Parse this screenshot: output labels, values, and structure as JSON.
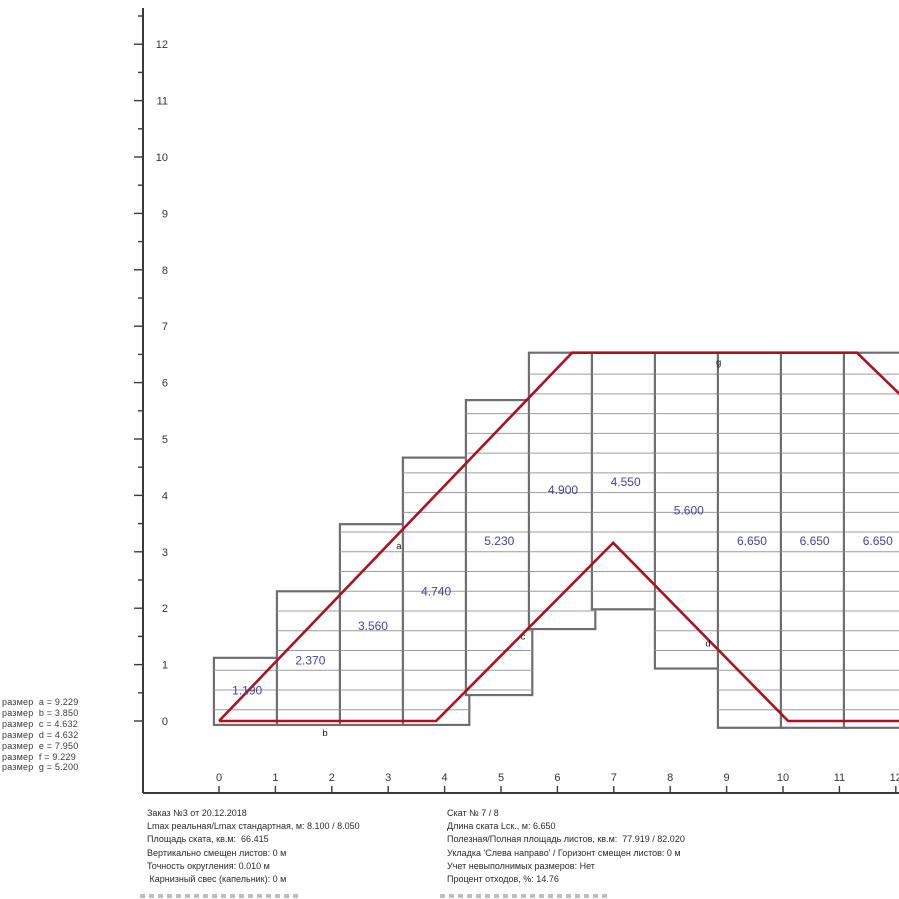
{
  "page": {
    "background": "#ffffff"
  },
  "legend": {
    "label_prefix": "размер",
    "items": [
      {
        "name": "a",
        "value": "9.229"
      },
      {
        "name": "b",
        "value": "3.850"
      },
      {
        "name": "c",
        "value": "4.632"
      },
      {
        "name": "d",
        "value": "4.632"
      },
      {
        "name": "e",
        "value": "7.950"
      },
      {
        "name": "f",
        "value": "9.229"
      },
      {
        "name": "g",
        "value": "5.200"
      }
    ]
  },
  "info_panel": {
    "left_lines": [
      "Заказ №3 от 20.12.2018",
      "Lmax реальная/Lmax стандартная, м: 8.100 / 8.050",
      "Площадь ската, кв.м:  66.415",
      "Вертикально смещен листов: 0 м",
      "Точность округления: 0.010 м",
      " Карнизный свес (капельник): 0 м"
    ],
    "right_lines": [
      "Скат № 7 / 8",
      "Длина ската Lск., м: 6.650",
      "Полезная/Полная площадь листов, кв.м:  77.919 / 82.020",
      "Укладка 'Слева направо' / Горизонт смещен листов: 0 м",
      "Учет невыполнимых размеров: Нет",
      "Процент отходов, %: 14.76"
    ]
  },
  "chart_data": {
    "type": "roof-sheet-layout",
    "title": "",
    "origin_px": [
      219,
      721
    ],
    "unit_px": 56.4,
    "axis_px": {
      "y_axis_x": 143,
      "x_axis_y": 793,
      "y_axis_top": 8
    },
    "x_axis": {
      "min": 0,
      "max": 12,
      "tick_step": 1,
      "labels": [
        "0",
        "1",
        "2",
        "3",
        "4",
        "5",
        "6",
        "7",
        "8",
        "9",
        "10",
        "11",
        "12"
      ]
    },
    "y_axis": {
      "min": 0,
      "max": 12,
      "tick_step": 1,
      "minor_step": 0.5,
      "minor_max": 12.5,
      "labels": [
        "0",
        "1",
        "2",
        "3",
        "4",
        "5",
        "6",
        "7",
        "8",
        "9",
        "10",
        "11",
        "12"
      ]
    },
    "module_row_step": 0.35,
    "module_row_origin": -0.15,
    "sheet_columns": [
      {
        "label": "1.190",
        "x": -0.09,
        "w": 1.177,
        "y0": -0.07,
        "y1": 1.12,
        "lx": 0.5,
        "ly": 0.54
      },
      {
        "label": "2.370",
        "x": 1.027,
        "w": 1.177,
        "y0": -0.07,
        "y1": 2.3,
        "lx": 1.62,
        "ly": 1.07
      },
      {
        "label": "3.560",
        "x": 2.144,
        "w": 1.177,
        "y0": -0.07,
        "y1": 3.49,
        "lx": 2.73,
        "ly": 1.68
      },
      {
        "label": "4.740",
        "x": 3.261,
        "w": 1.177,
        "y0": -0.07,
        "y1": 4.67,
        "lx": 3.85,
        "ly": 2.3
      },
      {
        "label": "5.230",
        "x": 4.378,
        "w": 1.177,
        "y0": 0.46,
        "y1": 5.69,
        "lx": 4.97,
        "ly": 3.19
      },
      {
        "label": "4.900",
        "x": 5.495,
        "w": 1.177,
        "y0": 1.63,
        "y1": 6.53,
        "lx": 6.1,
        "ly": 4.1
      },
      {
        "label": "4.550",
        "x": 6.612,
        "w": 1.177,
        "y0": 1.98,
        "y1": 6.53,
        "lx": 7.21,
        "ly": 4.24
      },
      {
        "label": "5.600",
        "x": 7.729,
        "w": 1.177,
        "y0": 0.93,
        "y1": 6.53,
        "lx": 8.33,
        "ly": 3.73
      },
      {
        "label": "6.650",
        "x": 8.846,
        "w": 1.177,
        "y0": -0.12,
        "y1": 6.53,
        "lx": 9.45,
        "ly": 3.19
      },
      {
        "label": "6.650",
        "x": 9.963,
        "w": 1.177,
        "y0": -0.12,
        "y1": 6.53,
        "lx": 10.56,
        "ly": 3.19
      },
      {
        "label": "6.650",
        "x": 11.08,
        "w": 1.177,
        "y0": -0.12,
        "y1": 6.53,
        "lx": 11.68,
        "ly": 3.19
      }
    ],
    "outline_paths": [
      [
        [
          0,
          0
        ],
        [
          6.26,
          6.53
        ],
        [
          11.31,
          6.53
        ],
        [
          12.25,
          5.62
        ]
      ],
      [
        [
          0,
          0
        ],
        [
          3.85,
          0
        ],
        [
          6.99,
          3.16
        ],
        [
          10.09,
          0
        ],
        [
          12.25,
          0
        ]
      ]
    ],
    "edge_labels": [
      {
        "t": "a",
        "x": 3.19,
        "y": 3.1
      },
      {
        "t": "b",
        "x": 1.88,
        "y": -0.21
      },
      {
        "t": "c",
        "x": 5.39,
        "y": 1.5
      },
      {
        "t": "d",
        "x": 8.67,
        "y": 1.37
      },
      {
        "t": "g",
        "x": 8.86,
        "y": 6.36
      }
    ],
    "colors": {
      "outline": "#AA1122",
      "sheet_border": "#6e6e6e",
      "row_line": "#9c9c9c",
      "sheet_fill": "#ffffff",
      "dim_text": "#4343a6",
      "edge_text": "#1a1a1a",
      "axis": "#3a3a3a",
      "axis_text": "#333333"
    }
  }
}
